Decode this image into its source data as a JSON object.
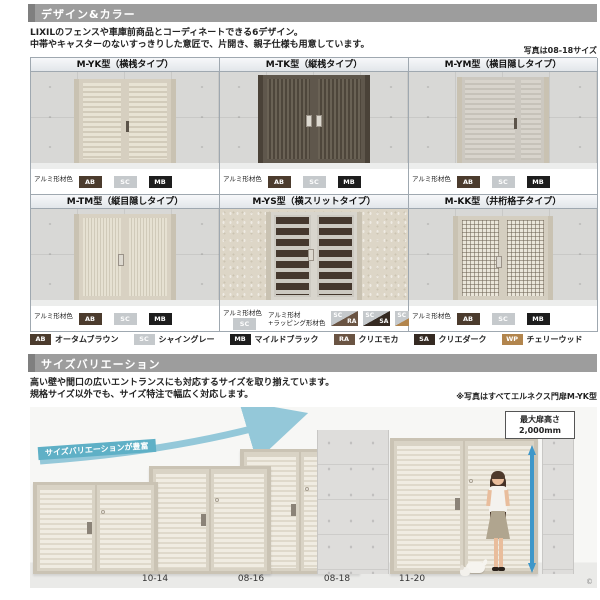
{
  "page": {
    "design_section": {
      "title": "デザイン&カラー",
      "intro_line1": "LIXILのフェンスや車庫前商品とコーディネートできる6デザイン。",
      "intro_line2": "中帯やキャスターのないすっきりした意匠で、片開き、親子仕様も用意しています。",
      "photo_note": "写真は08-18サイズ",
      "material_label": "アルミ形材色",
      "models": [
        {
          "name": "M-YK型（横桟タイプ）",
          "chips": [
            "AB",
            "SC",
            "MB"
          ]
        },
        {
          "name": "M-TK型（縦桟タイプ）",
          "chips": [
            "AB",
            "SC",
            "MB"
          ]
        },
        {
          "name": "M-YM型（横目隠しタイプ）",
          "chips": [
            "AB",
            "SC",
            "MB"
          ]
        },
        {
          "name": "M-TM型（縦目隠しタイプ）",
          "chips": [
            "AB",
            "SC",
            "MB"
          ]
        },
        {
          "name": "M-YS型（横スリットタイプ）",
          "chips": [
            "SC"
          ],
          "wrap_label1": "アルミ形材",
          "wrap_label2": "+ラッピング形材色",
          "wrap_chips": [
            [
              "SC",
              "RA"
            ],
            [
              "SC",
              "SA"
            ],
            [
              "SC",
              "WP"
            ]
          ]
        },
        {
          "name": "M-KK型（井桁格子タイプ）",
          "chips": [
            "AB",
            "SC",
            "MB"
          ]
        }
      ],
      "color_legend": [
        {
          "code": "AB",
          "name": "オータムブラウン",
          "hex": "#4b3b2d"
        },
        {
          "code": "SC",
          "name": "シャイングレー",
          "hex": "#c5c9cc"
        },
        {
          "code": "MB",
          "name": "マイルドブラック",
          "hex": "#1d1d1d"
        },
        {
          "code": "RA",
          "name": "クリエモカ",
          "hex": "#6a5443"
        },
        {
          "code": "SA",
          "name": "クリエダーク",
          "hex": "#352a22"
        },
        {
          "code": "WP",
          "name": "チェリーウッド",
          "hex": "#b2854d"
        }
      ]
    },
    "size_section": {
      "title": "サイズバリエーション",
      "intro_line1": "高い壁や間口の広いエントランスにも対応するサイズを取り揃えています。",
      "intro_line2": "規格サイズ以外でも、サイズ特注で幅広く対応します。",
      "note": "※写真はすべてエルネクス門扉M-YK型",
      "ribbon": "サイズバリエーションが豊富",
      "max_height_line1": "最大扉高さ",
      "max_height_line2": "2,000mm",
      "sizes": [
        "10-14",
        "08-16",
        "08-18",
        "11-20"
      ],
      "copyright": "©",
      "accent_color": "#5fb0c6",
      "arrow_color": "#3e97c9"
    }
  }
}
